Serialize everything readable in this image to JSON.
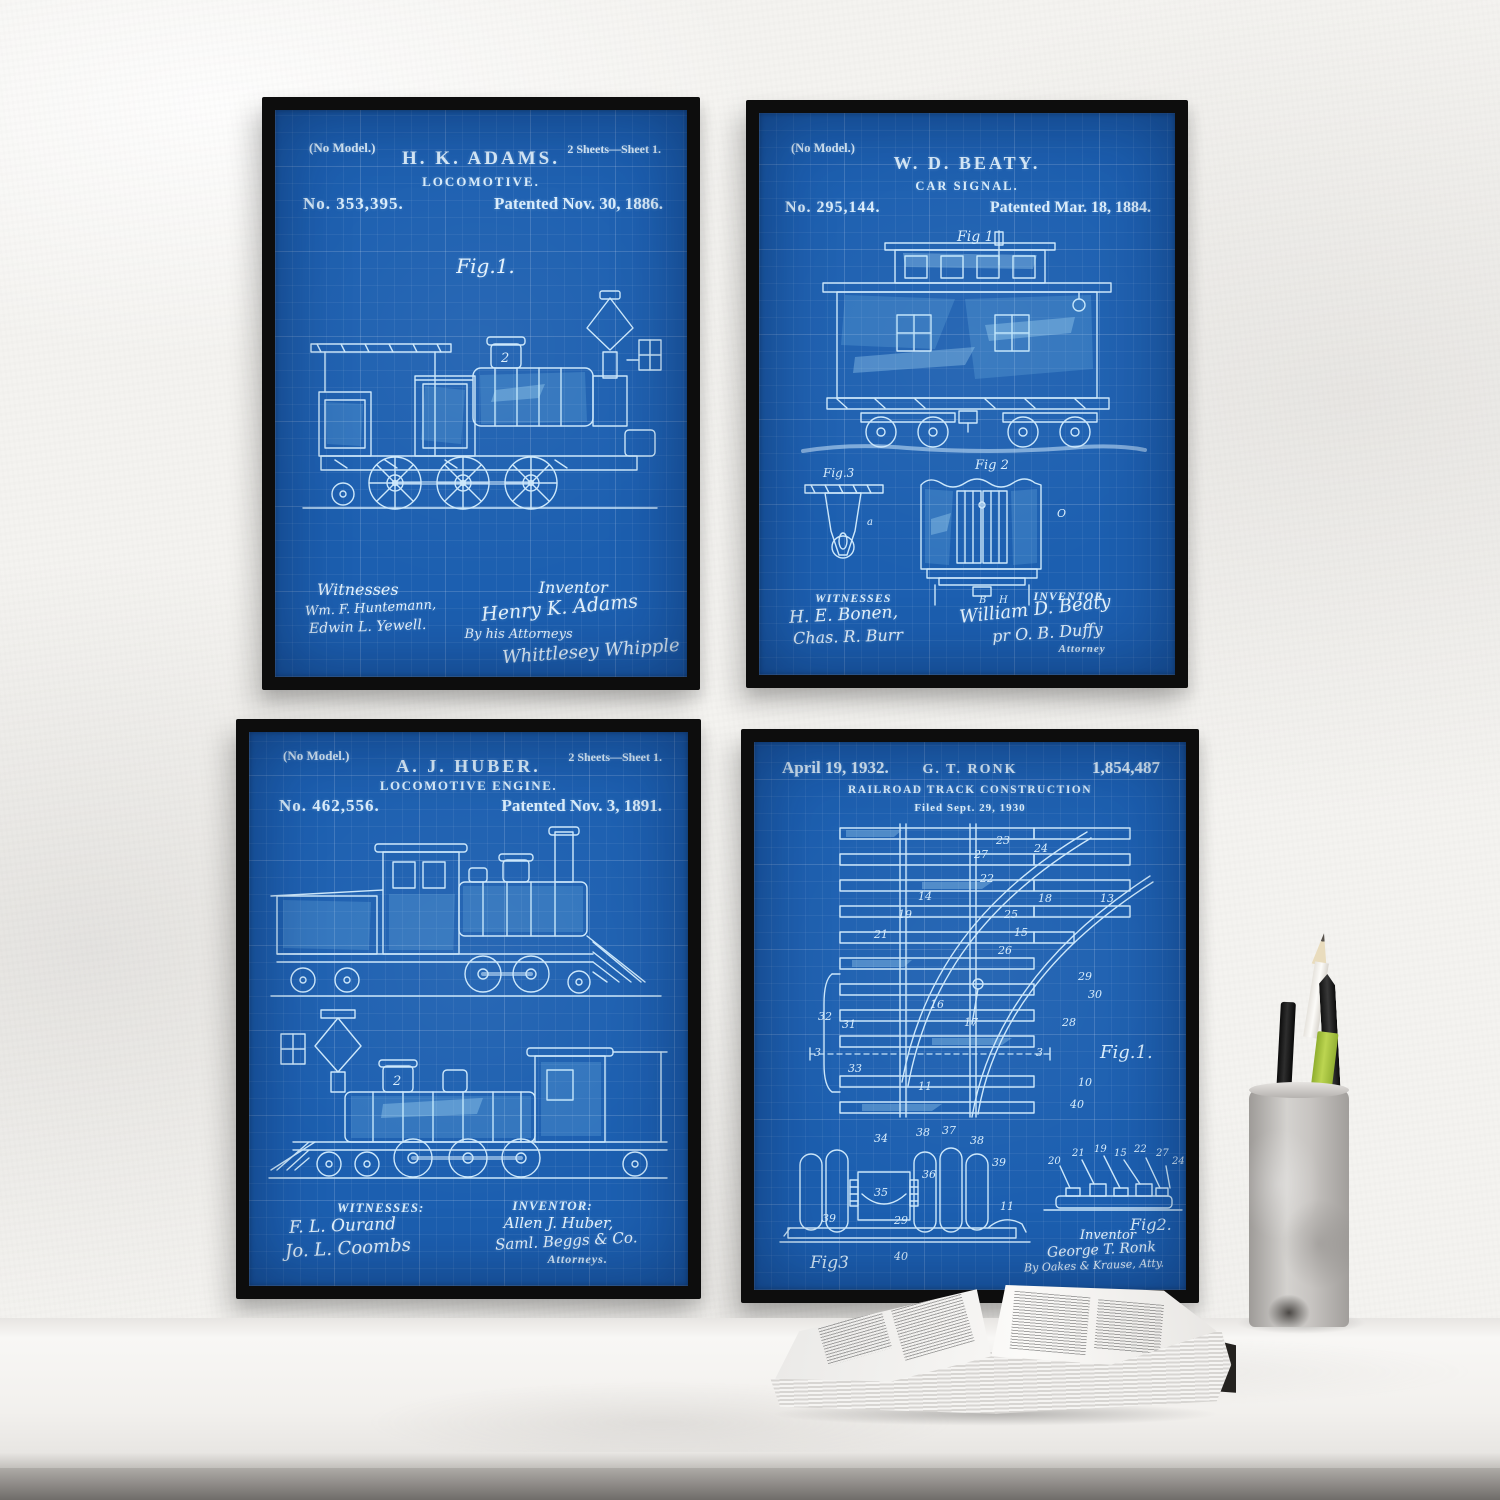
{
  "colors": {
    "blueprint_blue": "#1c5fb0",
    "line_blue": "#cde8fb",
    "frame_black": "#0d0d0d",
    "wall_white": "#f4f3f0",
    "pencil_green": "#a9c43d"
  },
  "posters": [
    {
      "no_model": "(No Model.)",
      "name": "H. K. ADAMS.",
      "title": "LOCOMOTIVE.",
      "sheets": "2 Sheets—Sheet 1.",
      "number": "No. 353,395.",
      "patented": "Patented Nov. 30, 1886.",
      "fig1": "Fig.1.",
      "dome_number": "2",
      "witnesses_label": "Witnesses",
      "witnesses": [
        "Wm. F. Huntemann,",
        "Edwin L. Yewell."
      ],
      "inventor_label": "Inventor",
      "inventor_sig": "Henry K. Adams",
      "by_attorneys_label": "By his Attorneys",
      "attorney_sig": "Whittlesey Whipple"
    },
    {
      "no_model": "(No Model.)",
      "name": "W. D. BEATY.",
      "title": "CAR SIGNAL.",
      "number": "No. 295,144.",
      "patented": "Patented Mar. 18, 1884.",
      "fig1": "Fig 1",
      "fig2": "Fig 2",
      "fig3": "Fig.3",
      "letters": {
        "a": "a",
        "o": "O",
        "b": "B",
        "h": "H"
      },
      "witnesses_label": "WITNESSES",
      "witnesses": [
        "H. E. Bonen,",
        "Chas. R. Burr"
      ],
      "inventor_label": "INVENTOR",
      "inventor_sig": "William D. Beaty",
      "per_attorney_sig": "pr O. B. Duffy",
      "attorney_label": "Attorney"
    },
    {
      "no_model": "(No Model.)",
      "name": "A. J. HUBER.",
      "title": "LOCOMOTIVE ENGINE.",
      "sheets": "2 Sheets—Sheet 1.",
      "number": "No. 462,556.",
      "patented": "Patented Nov. 3, 1891.",
      "dome_number": "2",
      "witnesses_label": "WITNESSES:",
      "witnesses": [
        "F. L. Ourand",
        "Jo. L. Coombs"
      ],
      "inventor_label": "INVENTOR:",
      "inventor_sig": "Allen J. Huber,",
      "attorney_sig": "Saml. Beggs & Co.",
      "attorneys_label": "Attorneys."
    },
    {
      "date": "April 19, 1932.",
      "name": "G. T. RONK",
      "number": "1,854,487",
      "title": "RAILROAD TRACK CONSTRUCTION",
      "filed": "Filed Sept. 29, 1930",
      "fig1": "Fig.1.",
      "fig2": "Fig2.",
      "fig3": "Fig3",
      "fig1_numbers": [
        "23",
        "27",
        "24",
        "22",
        "18",
        "13",
        "14",
        "19",
        "25",
        "15",
        "21",
        "26",
        "29",
        "30",
        "16",
        "17",
        "28",
        "32",
        "31",
        "33",
        "3",
        "3",
        "11",
        "10",
        "40"
      ],
      "fig3_numbers": [
        "34",
        "38",
        "37",
        "38",
        "39",
        "36",
        "35",
        "39",
        "29",
        "11",
        "40"
      ],
      "fig2_numbers": [
        "20",
        "21",
        "19",
        "15",
        "22",
        "27",
        "24"
      ],
      "inventor_label": "Inventor",
      "inventor_sig": "George T. Ronk",
      "attorney_sig": "By Oakes & Krause, Atty."
    }
  ]
}
